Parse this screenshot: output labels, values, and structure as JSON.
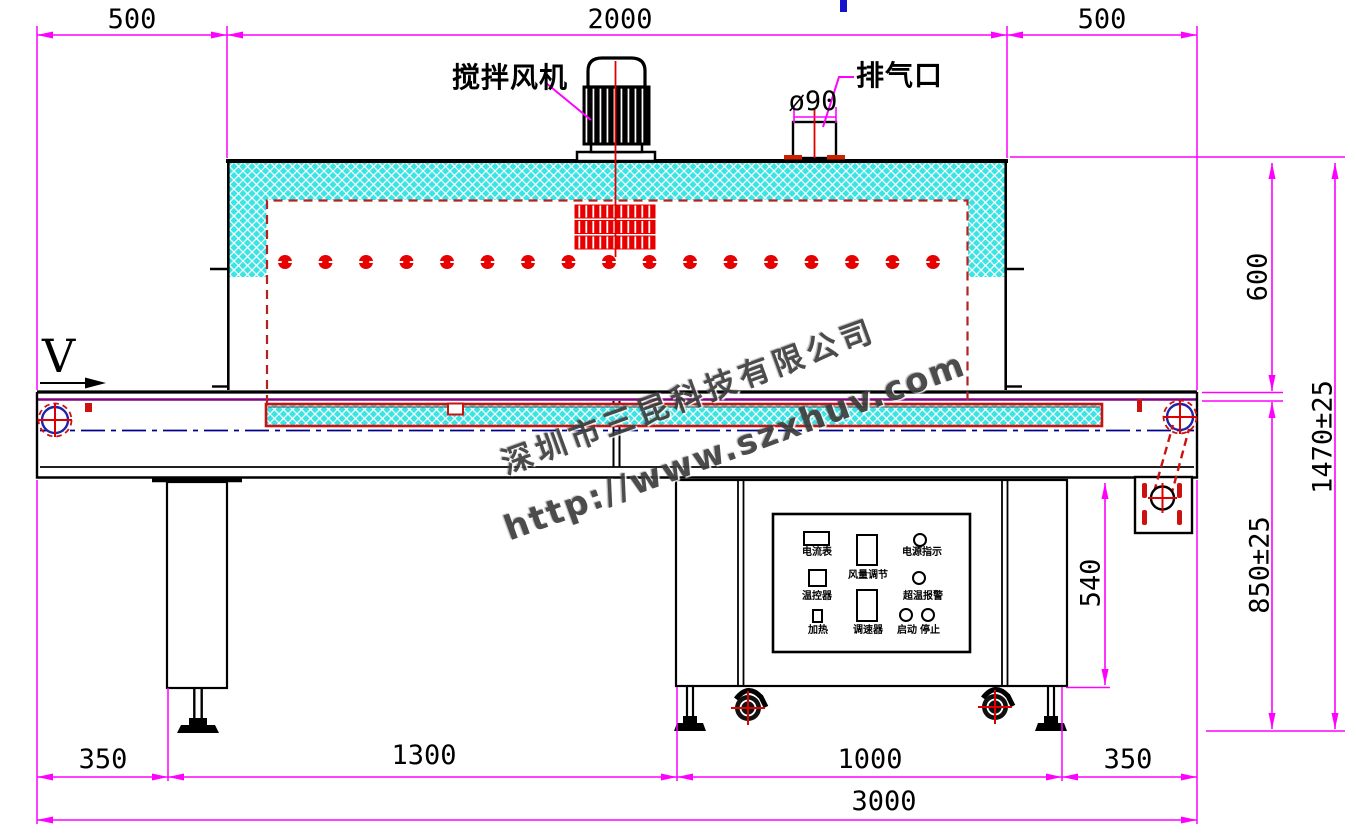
{
  "drawing": {
    "title_labels": {
      "stir_fan": "搅拌风机",
      "exhaust_port": "排气口",
      "exhaust_diameter": "ø90",
      "belt_direction": "V"
    },
    "dimensions": {
      "top": [
        "500",
        "2000",
        "500"
      ],
      "bottom": [
        "350",
        "1300",
        "1000",
        "350"
      ],
      "overall_length": "3000",
      "oven_height": "600",
      "overall_height": "1470±25",
      "belt_height": "850±25",
      "cabinet_height": "540"
    },
    "control_panel": {
      "ammeter": "电流表",
      "airflow_adjust": "风量调节",
      "power_indicator": "电源指示",
      "temp_controller": "温控器",
      "overtemp_alarm": "超温报警",
      "heating": "加热",
      "speed_controller": "调速器",
      "start": "启动",
      "stop": "停止"
    },
    "watermark": {
      "company": "深圳市三昆科技有限公司",
      "url": "http://www.szxhuv.com"
    },
    "heater_dot_count": 17,
    "colors": {
      "dimension": "#ff00ff",
      "insulation": "#38e4e4",
      "heater_red": "#e60000",
      "chamber_dashed": "#b22222",
      "centerline_blue": "#00008b",
      "belt_purple": "#800080"
    }
  }
}
